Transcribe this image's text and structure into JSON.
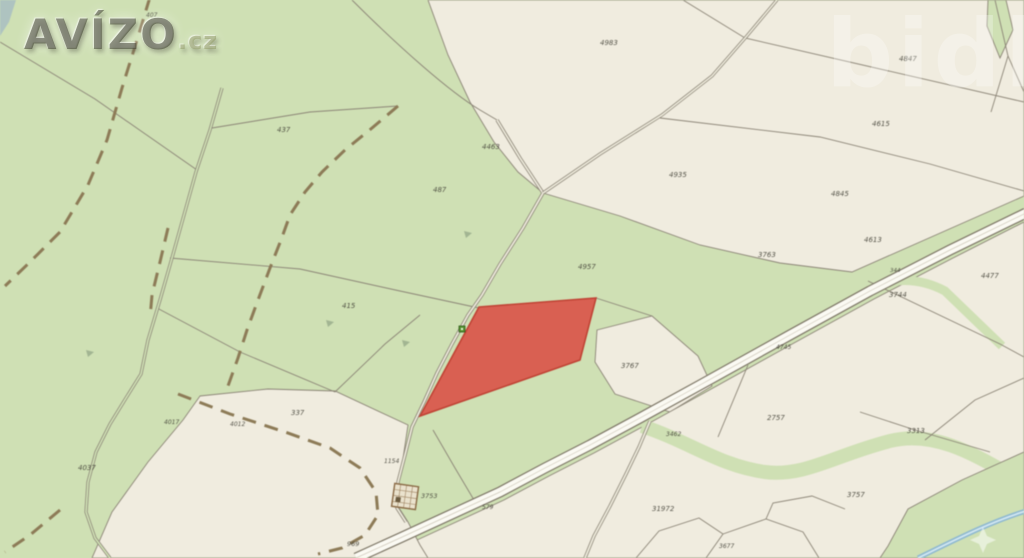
{
  "watermarks": {
    "brand": "AVÍZO",
    "brand_suffix": ".cz",
    "secondary": "bidli"
  },
  "colors": {
    "green": "#cfe0b4",
    "cream": "#f0ecdf",
    "line": "#8b8476",
    "roadedge": "#7e7767",
    "roadfill": "#fbfaf3",
    "roadmid": "#cfc9ba",
    "trackfill": "#ece9da",
    "redfill": "#d96052",
    "redstroke": "#c04335",
    "stream": "#8fb9cf",
    "streamcore": "#d2e7f2",
    "label": "#403f35",
    "brown": "#8d7b57",
    "bfill": "#eae2cd",
    "bstroke": "#8a6a45",
    "scrub": "#9aad8c",
    "cblue": "#a3b9c4",
    "marker": "#57932f"
  },
  "map": {
    "highlight_parcel_color": "#d96052",
    "labels": [
      {
        "t": "407",
        "x": 146,
        "y": 17,
        "s": 6
      },
      {
        "t": "437",
        "x": 277,
        "y": 132
      },
      {
        "t": "487",
        "x": 433,
        "y": 192
      },
      {
        "t": "4463",
        "x": 482,
        "y": 149
      },
      {
        "t": "4983",
        "x": 600,
        "y": 45
      },
      {
        "t": "4935",
        "x": 669,
        "y": 177
      },
      {
        "t": "4847",
        "x": 899,
        "y": 61
      },
      {
        "t": "4615",
        "x": 872,
        "y": 126
      },
      {
        "t": "4845",
        "x": 831,
        "y": 196
      },
      {
        "t": "4613",
        "x": 864,
        "y": 242
      },
      {
        "t": "344",
        "x": 890,
        "y": 272,
        "s": 5.5
      },
      {
        "t": "3744",
        "x": 889,
        "y": 297
      },
      {
        "t": "4477",
        "x": 981,
        "y": 278
      },
      {
        "t": "3763",
        "x": 758,
        "y": 257
      },
      {
        "t": "4957",
        "x": 578,
        "y": 269
      },
      {
        "t": "415",
        "x": 342,
        "y": 308
      },
      {
        "t": "337",
        "x": 291,
        "y": 415
      },
      {
        "t": "4017",
        "x": 164,
        "y": 424,
        "s": 6
      },
      {
        "t": "4012",
        "x": 230,
        "y": 426,
        "s": 6
      },
      {
        "t": "4037",
        "x": 78,
        "y": 470
      },
      {
        "t": "3767",
        "x": 621,
        "y": 368
      },
      {
        "t": "2757",
        "x": 767,
        "y": 420
      },
      {
        "t": "3462",
        "x": 666,
        "y": 436,
        "s": 6
      },
      {
        "t": "31972",
        "x": 652,
        "y": 511
      },
      {
        "t": "3757",
        "x": 847,
        "y": 497
      },
      {
        "t": "3313",
        "x": 907,
        "y": 433
      },
      {
        "t": "1154",
        "x": 384,
        "y": 463,
        "s": 6
      },
      {
        "t": "3753",
        "x": 421,
        "y": 498,
        "s": 6.5
      },
      {
        "t": "579",
        "x": 482,
        "y": 509,
        "s": 6
      },
      {
        "t": "969",
        "x": 347,
        "y": 546,
        "s": 6.5
      },
      {
        "t": "4745",
        "x": 776,
        "y": 349,
        "s": 6
      },
      {
        "t": "3677",
        "x": 719,
        "y": 548,
        "s": 6
      }
    ]
  }
}
